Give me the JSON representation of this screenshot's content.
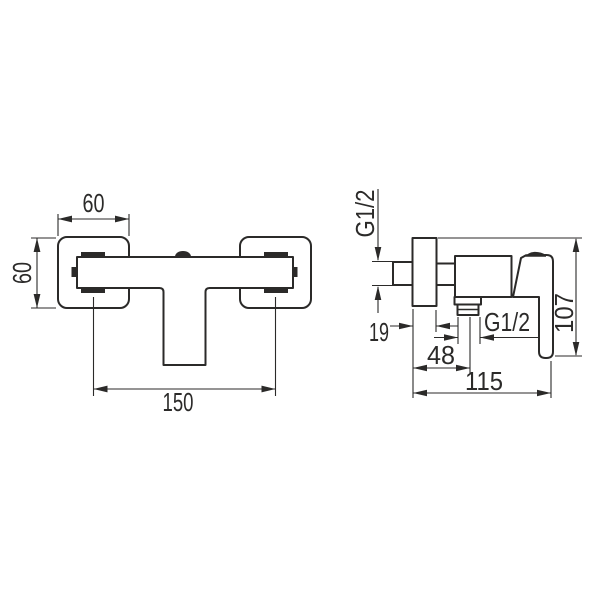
{
  "page": {
    "background_color": "#ffffff",
    "line_color": "#2b2a29"
  },
  "front_view": {
    "dim_width_top": "60",
    "dim_height_left": "60",
    "dim_hole_spacing": "150"
  },
  "side_view": {
    "inlet_thread": "G1/2",
    "outlet_thread": "G1/2",
    "dim_wall_offset": "19",
    "dim_outlet_center_depth": "48",
    "dim_total_depth": "115",
    "dim_total_height": "107"
  }
}
